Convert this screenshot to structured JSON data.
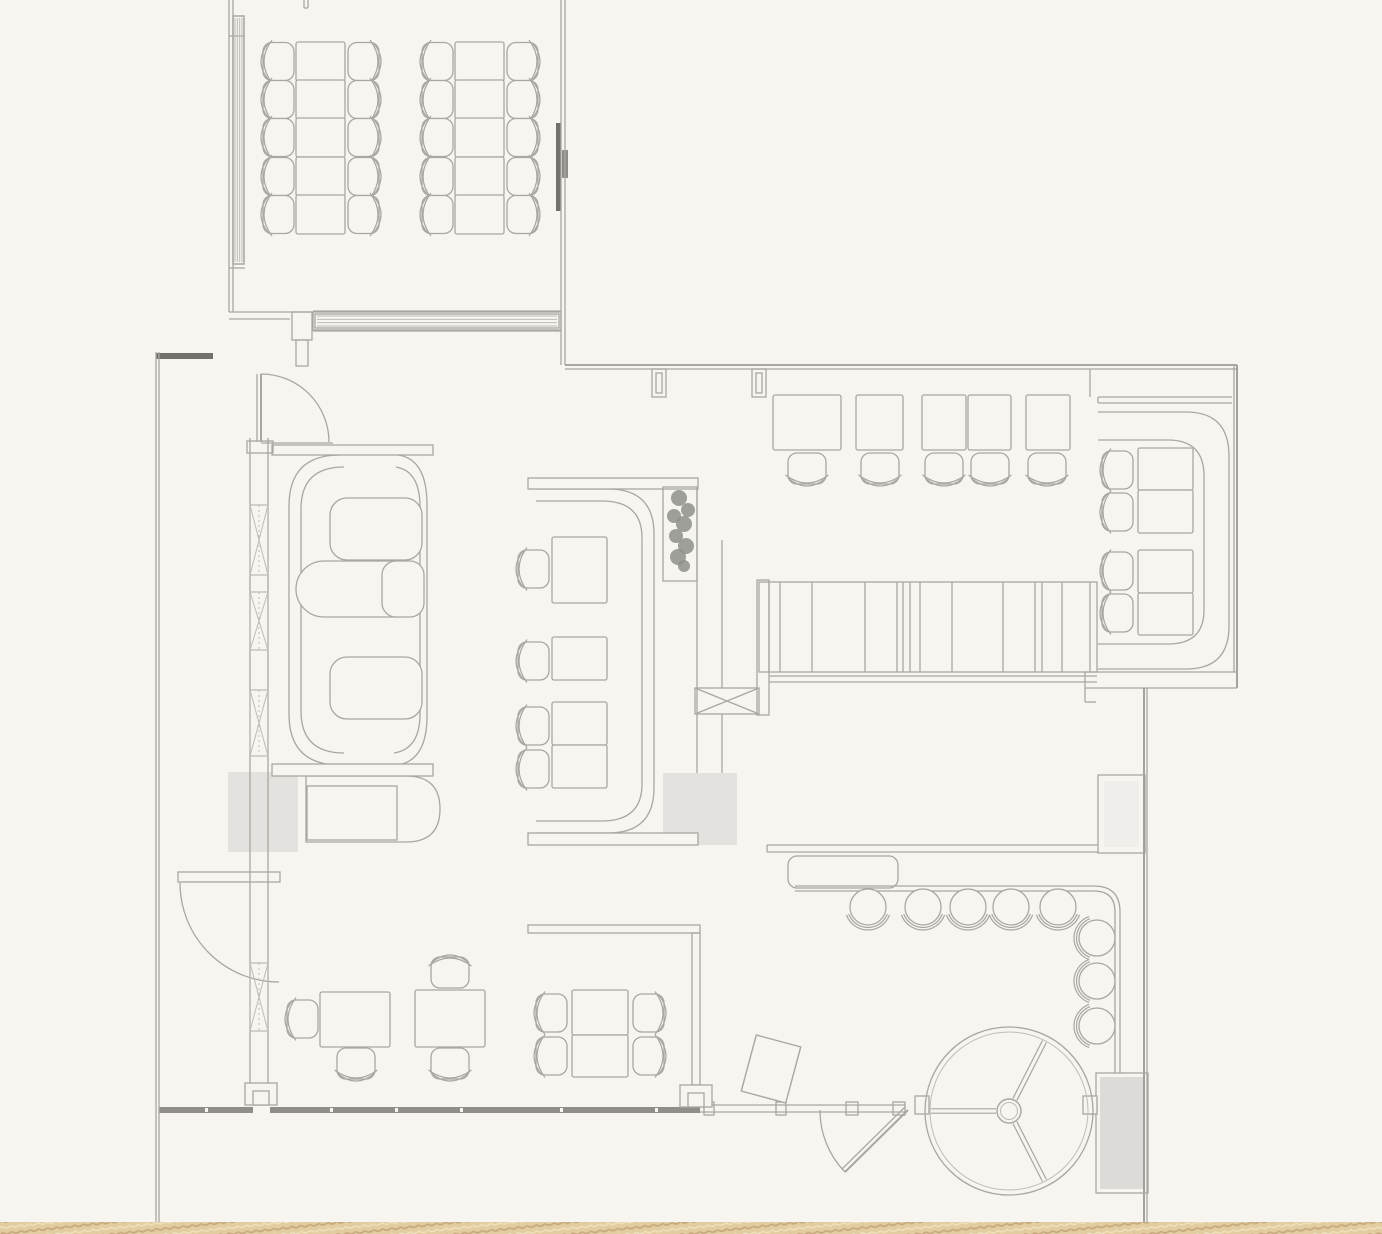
{
  "meta": {
    "document_type": "restaurant-floor-plan",
    "canvas": {
      "width": 1382,
      "height": 1234
    }
  },
  "palette": {
    "bg": "#f7f5f0",
    "line": "#a8a7a2",
    "soft": "#bdbcb8",
    "mid": "#8f8e8a",
    "dark": "#72716d",
    "gray": "#e3e2df",
    "gray2": "#dcdbd8",
    "duct": "#efeeeb",
    "plant": "#8e8f88",
    "sand": "#e2cda1",
    "sand_dark": "#c6a97c",
    "sand_light": "#f0e3c0"
  },
  "structure": {
    "fills": [
      [
        228,
        772,
        70,
        80,
        "gray"
      ],
      [
        663,
        773,
        74,
        72,
        "gray"
      ],
      [
        1100,
        1077,
        45,
        112,
        "gray2"
      ],
      [
        1104,
        781,
        35,
        66,
        "duct"
      ],
      [
        556,
        123,
        5,
        88,
        "dark"
      ],
      [
        562,
        150,
        6,
        28,
        "mid"
      ],
      [
        156,
        353,
        57,
        6,
        "dark"
      ],
      [
        159,
        1107,
        94,
        6,
        "mid"
      ],
      [
        270,
        1107,
        430,
        6,
        "mid"
      ],
      [
        205,
        1108,
        3,
        4,
        "bg"
      ],
      [
        330,
        1108,
        3,
        4,
        "bg"
      ],
      [
        395,
        1108,
        3,
        4,
        "bg"
      ],
      [
        460,
        1108,
        3,
        4,
        "bg"
      ],
      [
        560,
        1108,
        3,
        4,
        "bg"
      ],
      [
        655,
        1108,
        3,
        4,
        "bg"
      ],
      [
        0,
        1222,
        1382,
        12,
        "sandpat"
      ]
    ],
    "lines": [
      [
        229,
        0,
        229,
        312
      ],
      [
        233,
        0,
        233,
        312
      ],
      [
        229,
        36,
        245,
        36
      ],
      [
        229,
        268,
        245,
        268
      ],
      [
        561,
        0,
        561,
        365
      ],
      [
        565,
        0,
        565,
        365
      ],
      [
        304,
        0,
        304,
        8
      ],
      [
        308,
        0,
        308,
        8
      ],
      [
        304,
        8,
        308,
        8
      ],
      [
        229,
        312,
        312,
        312
      ],
      [
        229,
        319,
        290,
        319
      ],
      [
        261,
        374,
        261,
        442,
        2
      ],
      [
        257,
        374,
        257,
        442
      ],
      [
        261,
        443,
        333,
        443
      ],
      [
        156,
        352,
        156,
        1222
      ],
      [
        159,
        352,
        159,
        1222
      ],
      [
        565,
        365,
        1237,
        365,
        1.6,
        "mid"
      ],
      [
        565,
        369,
        1237,
        369
      ],
      [
        1234,
        365,
        1234,
        672
      ],
      [
        1237,
        365,
        1237,
        688,
        1.6,
        "mid"
      ],
      [
        1085,
        672,
        1237,
        672
      ],
      [
        1085,
        688,
        1237,
        688
      ],
      [
        1085,
        672,
        1085,
        688
      ],
      [
        1085,
        688,
        1085,
        702
      ],
      [
        1085,
        702,
        1096,
        702
      ],
      [
        1098,
        397,
        1232,
        397
      ],
      [
        1098,
        403,
        1232,
        403
      ],
      [
        1090,
        369,
        1090,
        397
      ],
      [
        1098,
        397,
        1098,
        403
      ],
      [
        1144,
        688,
        1144,
        1222,
        1.6,
        "mid"
      ],
      [
        1147,
        688,
        1147,
        1222
      ],
      [
        697,
        487,
        697,
        773
      ],
      [
        722,
        540,
        722,
        688
      ],
      [
        722,
        714,
        722,
        773
      ],
      [
        767,
        845,
        1098,
        845
      ],
      [
        767,
        852,
        1098,
        852
      ],
      [
        767,
        845,
        767,
        852
      ],
      [
        769,
        676,
        1097,
        676
      ],
      [
        769,
        682,
        1097,
        682
      ],
      [
        700,
        1105,
        905,
        1105
      ],
      [
        700,
        1112,
        905,
        1112
      ],
      [
        908,
        1110,
        845,
        1172,
        2
      ],
      [
        905,
        1107,
        842,
        1169
      ],
      [
        250,
        438,
        250,
        1083
      ],
      [
        268,
        438,
        268,
        1083
      ],
      [
        313,
        311,
        561,
        311
      ],
      [
        313,
        331,
        561,
        331
      ],
      [
        695,
        688,
        759,
        714
      ],
      [
        695,
        714,
        759,
        688
      ]
    ],
    "rects": [
      [
        759,
        582,
        338,
        90,
        0
      ],
      [
        757,
        580,
        12,
        135,
        0
      ],
      [
        695,
        688,
        64,
        26,
        0
      ],
      [
        788,
        856,
        110,
        32,
        9
      ],
      [
        1098,
        775,
        47,
        78,
        0
      ],
      [
        1096,
        1073,
        52,
        120,
        0
      ],
      [
        1088,
        1100,
        9,
        14,
        0
      ],
      [
        528,
        925,
        172,
        8,
        0
      ],
      [
        692,
        933,
        8,
        152,
        0
      ],
      [
        178,
        872,
        102,
        10,
        0
      ],
      [
        704,
        1102,
        10,
        13,
        0
      ],
      [
        776,
        1102,
        10,
        13,
        0
      ],
      [
        846,
        1102,
        12,
        13,
        0
      ],
      [
        893,
        1102,
        12,
        13,
        0
      ],
      [
        313,
        312,
        248,
        18,
        0
      ],
      [
        233,
        16,
        11,
        248,
        0
      ],
      [
        247,
        441,
        26,
        12,
        0
      ],
      [
        292,
        312,
        20,
        28,
        0
      ],
      [
        296,
        340,
        12,
        26,
        0
      ],
      [
        652,
        369,
        14,
        28,
        0
      ],
      [
        656,
        373,
        6,
        20,
        0
      ],
      [
        752,
        369,
        14,
        28,
        0
      ],
      [
        756,
        373,
        6,
        20,
        0
      ]
    ],
    "rects_bg": [
      [
        680,
        1085,
        32,
        22
      ],
      [
        688,
        1093,
        16,
        14
      ],
      [
        245,
        1083,
        32,
        22
      ],
      [
        253,
        1091,
        16,
        14
      ],
      [
        915,
        1096,
        14,
        18
      ],
      [
        1083,
        1096,
        14,
        18
      ]
    ],
    "paths": [
      [
        "M 261,374 A 68 68 0 0 1 329,442"
      ],
      [
        "M 180,883 A 99 99 0 0 0 279,982"
      ],
      [
        "M 820,1110 A 88 88 0 0 0 845,1172"
      ],
      [
        "M 795,886 L 1094,886 Q 1120,886 1120,912 L 1120,1073"
      ],
      [
        "M 795,891 L 1094,891 Q 1115,891 1115,912 L 1115,1073"
      ]
    ],
    "bar_dividers": {
      "y1": 582,
      "y2": 672,
      "xs": [
        769,
        780,
        812,
        865,
        897,
        903,
        910,
        920,
        952,
        1003,
        1035,
        1042,
        1062,
        1090
      ]
    },
    "glazing_bands": [
      {
        "x": 233,
        "y": 16,
        "w": 11,
        "h": 248,
        "dir": "v",
        "n": 4
      },
      {
        "x": 315,
        "y": 314,
        "w": 244,
        "h": 14,
        "dir": "h",
        "n": 4
      }
    ],
    "mullions": [
      {
        "x": 250,
        "y": 505,
        "w": 18,
        "h": 70
      },
      {
        "x": 250,
        "y": 592,
        "w": 18,
        "h": 58
      },
      {
        "x": 250,
        "y": 690,
        "w": 18,
        "h": 66
      },
      {
        "x": 250,
        "y": 963,
        "w": 18,
        "h": 68
      }
    ]
  },
  "booths": {
    "caps": [
      [
        272,
        445,
        161,
        10
      ],
      [
        272,
        764,
        161,
        12
      ],
      [
        528,
        478,
        170,
        11
      ],
      [
        528,
        833,
        170,
        12
      ]
    ],
    "pods": [
      [
        330,
        498,
        92,
        62,
        17
      ],
      [
        330,
        657,
        92,
        62,
        17
      ],
      [
        296,
        561,
        128,
        56,
        28
      ],
      [
        382,
        561,
        42,
        56,
        14
      ]
    ],
    "paths": [
      [
        "M 340,455 Q 289,455 289,506 L 289,714 Q 289,765 340,765"
      ],
      [
        "M 344,467 Q 301,467 301,509 L 301,711 Q 301,753 344,753"
      ],
      [
        "M 398,455 Q 427,459 427,505 L 427,716 Q 427,760 398,765"
      ],
      [
        "M 396,467 Q 420,471 420,507 L 420,714 Q 420,749 394,753"
      ],
      [
        "M 306,776 L 406,776 Q 440,776 440,809 Q 440,842 406,842 L 306,842 Z"
      ],
      [
        "M 536,489 L 608,489 Q 654,489 654,534 L 654,788 Q 654,833 608,833 L 536,833"
      ],
      [
        "M 536,501 L 602,501 Q 642,501 642,538 L 642,784 Q 642,821 602,821 L 536,821"
      ],
      [
        "M 1098,412 L 1186,412 Q 1229,412 1229,456 L 1229,626 Q 1229,669 1186,669 L 1098,669"
      ],
      [
        "M 1098,440 L 1168,440 Q 1204,440 1204,476 L 1204,610 Q 1204,644 1168,644 L 1098,644"
      ]
    ],
    "booth_table": [
      307,
      786,
      90,
      54
    ]
  },
  "furniture": {
    "private_room": {
      "row_tops": [
        42,
        80,
        118,
        157,
        195
      ],
      "row_h": 39,
      "table_w": 49,
      "cols": [
        {
          "tx": 296,
          "cl": 278,
          "cr": 364
        },
        {
          "tx": 455,
          "cl": 437,
          "cr": 523
        }
      ]
    },
    "bar": {
      "tables": [
        [
          773,
          395,
          68,
          55
        ],
        [
          856,
          395,
          47,
          55
        ],
        [
          922,
          395,
          44,
          55
        ],
        [
          968,
          395,
          43,
          55
        ],
        [
          1026,
          395,
          44,
          55
        ]
      ],
      "chair_cxs": [
        807,
        880,
        944,
        990,
        1047
      ],
      "chair_cy": 469
    },
    "center_banquette": {
      "tables": [
        [
          552,
          537,
          55,
          66
        ],
        [
          552,
          637,
          55,
          43
        ],
        [
          552,
          702,
          55,
          43
        ],
        [
          552,
          745,
          55,
          43
        ]
      ],
      "chairs": [
        [
          533,
          569
        ],
        [
          533,
          661
        ],
        [
          533,
          726
        ],
        [
          533,
          769
        ]
      ]
    },
    "right_booth": {
      "tables": [
        [
          1138,
          448,
          55,
          42
        ],
        [
          1138,
          490,
          55,
          43
        ],
        [
          1138,
          550,
          55,
          43
        ],
        [
          1138,
          593,
          55,
          42
        ]
      ],
      "chairs": [
        [
          1117,
          470
        ],
        [
          1117,
          512
        ],
        [
          1117,
          571
        ],
        [
          1117,
          613
        ]
      ]
    },
    "floor_tables": [
      [
        320,
        992,
        70,
        55
      ],
      [
        415,
        990,
        70,
        57
      ],
      [
        572,
        990,
        56,
        45
      ],
      [
        572,
        1035,
        56,
        42
      ]
    ],
    "floor_chairs": [
      [
        302,
        1019,
        "left"
      ],
      [
        356,
        1064,
        "down"
      ],
      [
        450,
        972,
        "up"
      ],
      [
        450,
        1064,
        "down"
      ],
      [
        551,
        1013,
        "left"
      ],
      [
        551,
        1056,
        "left"
      ],
      [
        649,
        1013,
        "right"
      ],
      [
        649,
        1056,
        "right"
      ]
    ],
    "stools": {
      "top": [
        [
          868,
          907
        ],
        [
          923,
          907
        ],
        [
          968,
          907
        ],
        [
          1011,
          907
        ],
        [
          1058,
          907
        ]
      ],
      "right": [
        [
          1097,
          938
        ],
        [
          1097,
          981
        ],
        [
          1097,
          1026
        ]
      ]
    },
    "host_stand": {
      "x": 748,
      "y": 1040,
      "w": 46,
      "h": 58,
      "rot": 15
    }
  },
  "revolving_door": {
    "cx": 1009,
    "cy": 1111,
    "r": 84,
    "r2": 79,
    "hub": 12,
    "spokes": [
      180,
      -63,
      63
    ]
  },
  "plant": {
    "box": [
      663,
      487,
      34,
      94
    ],
    "leaves": [
      [
        679,
        498,
        8
      ],
      [
        688,
        510,
        7
      ],
      [
        674,
        516,
        7
      ],
      [
        684,
        524,
        8
      ],
      [
        676,
        536,
        7
      ],
      [
        686,
        546,
        8
      ],
      [
        678,
        557,
        8
      ],
      [
        684,
        566,
        6
      ]
    ]
  }
}
